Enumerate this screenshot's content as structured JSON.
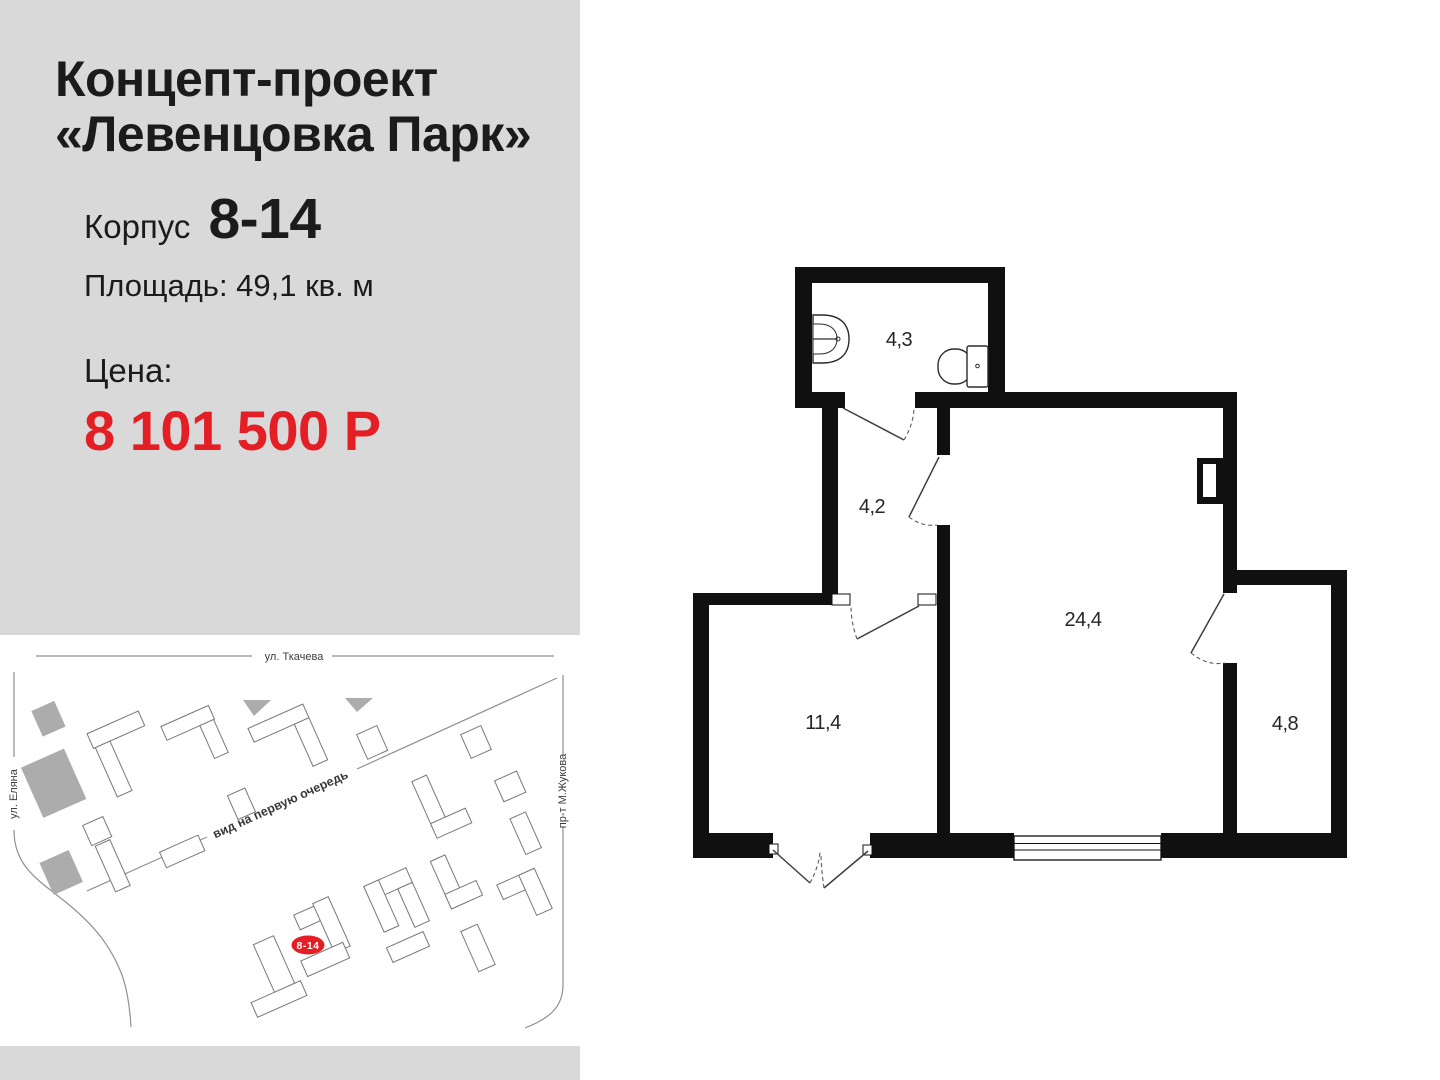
{
  "panel": {
    "title_line1": "Концепт-проект",
    "title_line2": "«Левенцовка Парк»",
    "korpus_label": "Корпус",
    "korpus_value": "8-14",
    "area_text": "Площадь: 49,1 кв. м",
    "price_label": "Цена:",
    "price_value": "8 101 500 Р"
  },
  "map": {
    "street_top": "ул. Ткачева",
    "street_left": "ул. Еляна",
    "street_right": "пр-т М.Жукова",
    "street_diagonal": "вид на первую очередь",
    "badge": "8-14"
  },
  "floorplan": {
    "rooms": [
      {
        "name": "bathroom",
        "area": "4,3"
      },
      {
        "name": "hallway",
        "area": "4,2"
      },
      {
        "name": "living-room",
        "area": "24,4"
      },
      {
        "name": "bedroom",
        "area": "11,4"
      },
      {
        "name": "loggia",
        "area": "4,8"
      }
    ]
  },
  "colors": {
    "accent_red": "#e31e24",
    "panel_gray": "#d9d9d9",
    "map_building_gray": "#acacac",
    "wall_black": "#101010"
  }
}
